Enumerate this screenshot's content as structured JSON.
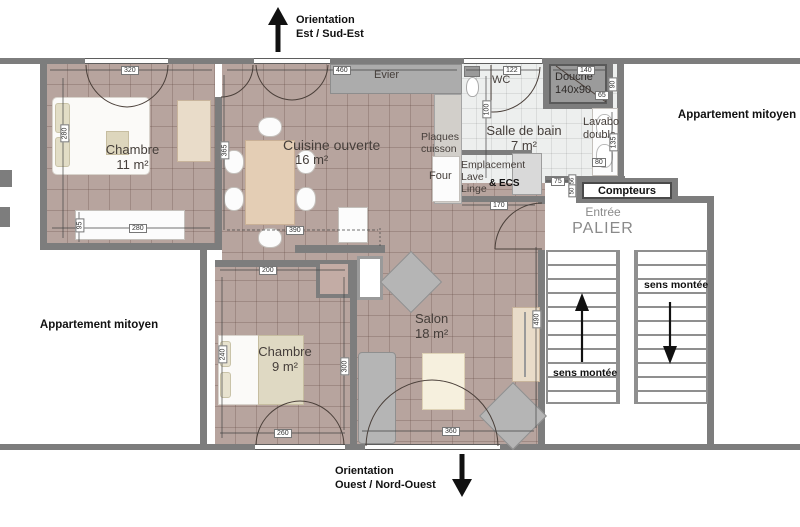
{
  "orientation": {
    "top": {
      "line1": "Orientation",
      "line2": "Est / Sud-Est"
    },
    "bottom": {
      "line1": "Orientation",
      "line2": "Ouest / Nord-Ouest"
    }
  },
  "neighbors": {
    "left": "Appartement mitoyen",
    "right": "Appartement mitoyen"
  },
  "rooms": {
    "chambre1": {
      "name": "Chambre",
      "area": "11 m²"
    },
    "cuisine": {
      "name": "Cuisine ouverte",
      "area": "16 m²"
    },
    "chambre2": {
      "name": "Chambre",
      "area": "9 m²"
    },
    "salon": {
      "name": "Salon",
      "area": "18 m²"
    },
    "salle_de_bain": {
      "name": "Salle de bain",
      "area": "7 m²"
    },
    "wc": {
      "name": "WC"
    },
    "douche": {
      "name": "Douche",
      "size": "140x90"
    },
    "lavabo": {
      "line1": "Lavabo",
      "line2": "double"
    }
  },
  "kitchen": {
    "evier": "Evier",
    "plaques_line1": "Plaques",
    "plaques_line2": "cuisson",
    "four": "Four"
  },
  "utility": {
    "line1": "Emplacement",
    "line2": "Lave",
    "line3": "Linge",
    "ecs": "& ECS"
  },
  "stairwell": {
    "compteurs": "Compteurs",
    "entree": "Entrée",
    "palier": "PALIER",
    "sens_left": "sens montée",
    "sens_right": "sens montée"
  },
  "dimensions": {
    "c11_top": "320",
    "c11_left": "280",
    "c11_bottom": "280",
    "c11_side": "95",
    "kitchen_top": "460",
    "kitchen_left": "365",
    "kitchen_bottom": "390",
    "c9_top": "200",
    "c9_left": "240",
    "c9_bottom": "260",
    "c9_right": "300",
    "salon_bottom": "360",
    "salon_right": "490",
    "wc_top": "122",
    "douche_top": "140",
    "douche_right": "90",
    "douche_inner": "65",
    "sdb_left": "100",
    "lavabo_side": "135",
    "lavabo_bottom": "80",
    "hall_door": "75",
    "hall_small_a": "56",
    "hall_small_b": "50",
    "hall_width": "170"
  },
  "colors": {
    "floor": "#b7a49e",
    "wall": "#7d7d7d",
    "bath_floor": "#edefee",
    "douche": "#9b9b9b",
    "ink": "#111111"
  }
}
